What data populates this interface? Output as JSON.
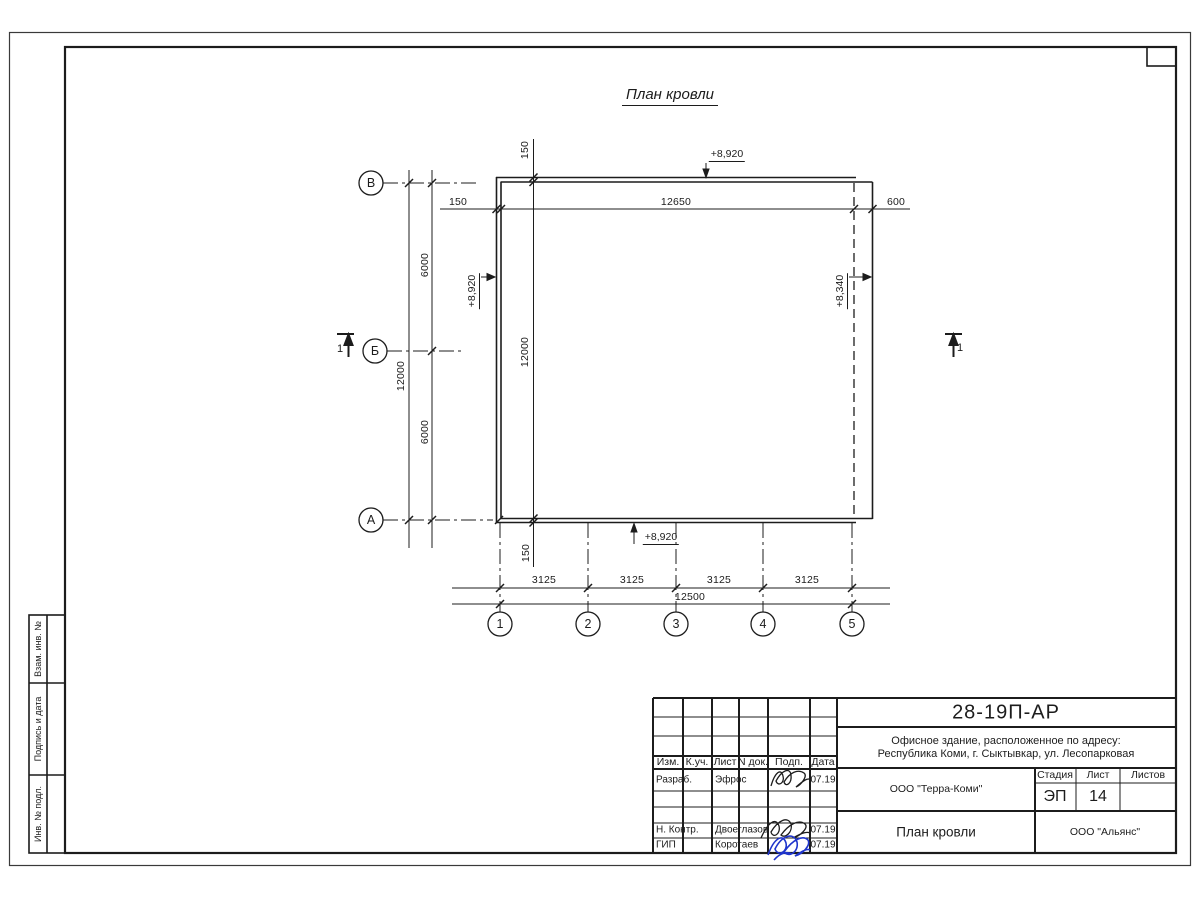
{
  "drawing_title_heading": "План кровли",
  "axis_row_labels": [
    "В",
    "Б",
    "А"
  ],
  "axis_col_labels": [
    "1",
    "2",
    "3",
    "4",
    "5"
  ],
  "dims": {
    "top": [
      "150",
      "12650",
      "600"
    ],
    "left_total": "12000",
    "left_spans": [
      "6000",
      "6000"
    ],
    "inner": [
      "150",
      "12000",
      "150"
    ],
    "bottom_spans": [
      "3125",
      "3125",
      "3125",
      "3125"
    ],
    "bottom_total": "12500"
  },
  "levels": {
    "top": "+8,920",
    "left": "+8,920",
    "bottom": "+8,920",
    "right": "+8,340"
  },
  "section_label": "1",
  "side_strip": {
    "block1": "Взам. инв. №",
    "block2": "Подпись и дата",
    "block3": "Инв. № подл."
  },
  "title_block": {
    "doc_number": "28-19П-АР",
    "object_address_line1": "Офисное здание, расположенное по адресу:",
    "object_address_line2": "Республика Коми, г. Сыктывкар, ул. Лесопарковая",
    "columns": {
      "izm": "Изм.",
      "kuch": "К.уч.",
      "list": "Лист",
      "ndoc": "N док.",
      "podp": "Подп.",
      "data": "Дата"
    },
    "rows": [
      {
        "role": "Разраб.",
        "name": "Эфрос",
        "date": "07.19"
      },
      {
        "role": "Н. Контр.",
        "name": "Двоеглазов",
        "date": "07.19"
      },
      {
        "role": "ГИП",
        "name": "Коротаев",
        "date": "07.19"
      }
    ],
    "company": "ООО \"Терра-Коми\"",
    "stage_label": "Стадия",
    "sheet_label": "Лист",
    "sheets_label": "Листов",
    "stage_value": "ЭП",
    "sheet_value": "14",
    "sheets_value": "",
    "drawing_title": "План кровли",
    "contractor": "ООО \"Альянс\""
  },
  "colors": {
    "line": "#1c1c1c",
    "signature_blue": "#1f35cc"
  }
}
